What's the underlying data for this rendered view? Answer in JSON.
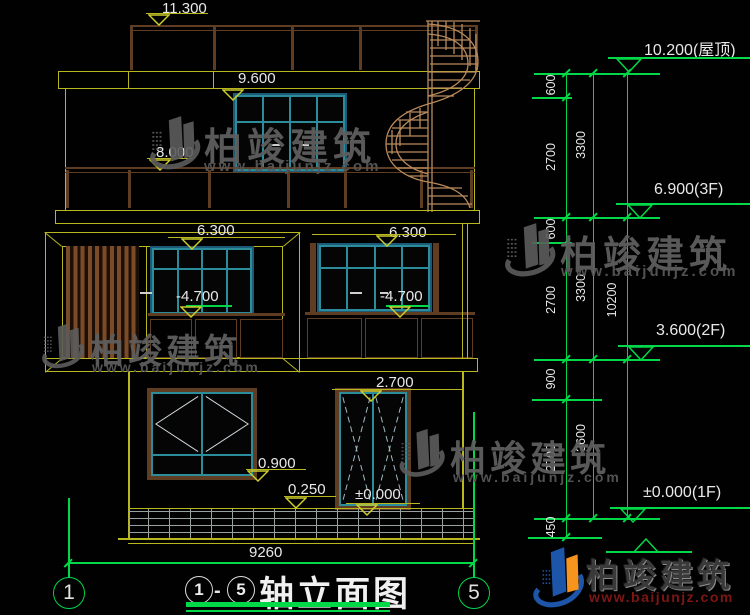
{
  "watermark": {
    "brand": "柏竣建筑",
    "site": "www.baijunjz.com"
  },
  "drawing": {
    "marks": {
      "m11_300": "11.300",
      "m9_600": "9.600",
      "m8_000": "8.000",
      "m6_300_l": "6.300",
      "m6_300_r": "6.300",
      "m4_700_l": "-4.700",
      "m4_700_r": "-4.700",
      "m2_700": "2.700",
      "m0_900": "0.900",
      "m0_250": "0.250",
      "m0_000": "±0.000"
    },
    "levels": {
      "roof": "10.200(屋顶)",
      "f3": "6.900(3F)",
      "f2": "3.600(2F)",
      "f1": "±0.000(1F)"
    },
    "chain": {
      "col1": [
        "600",
        "2700",
        "600",
        "2700",
        "900",
        "2700",
        "450"
      ],
      "col2": [
        "3300",
        "3300",
        "3600"
      ],
      "col3": [
        "10200"
      ]
    },
    "overall_width": "9260",
    "axes": {
      "left": "1",
      "right": "5"
    },
    "title": {
      "start": "1",
      "sep": "-",
      "end": "5",
      "name": "轴立面图"
    }
  }
}
